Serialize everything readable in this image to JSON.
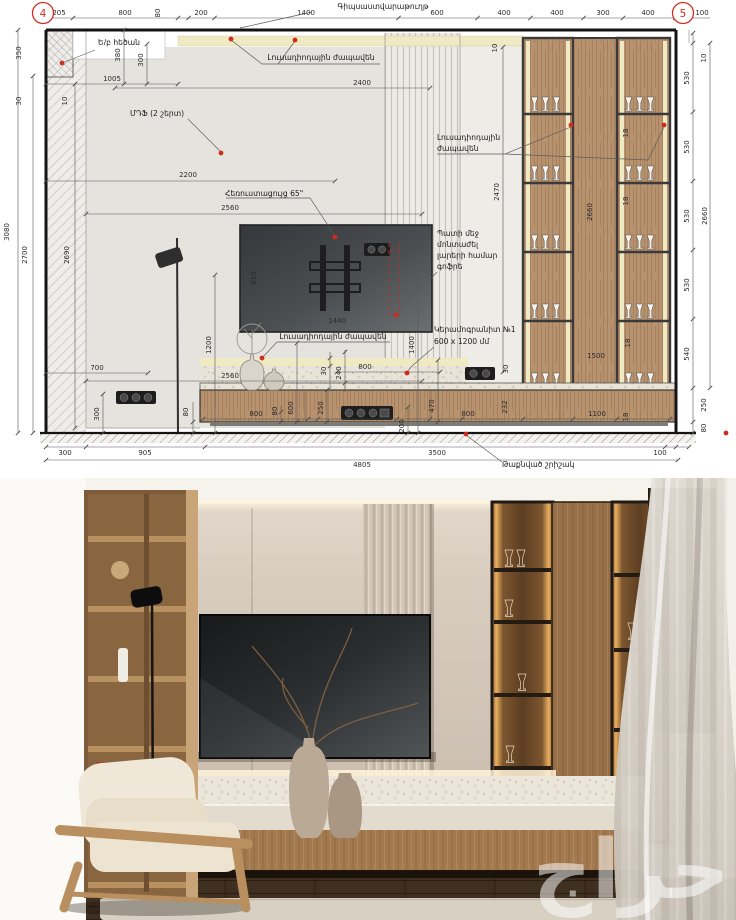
{
  "colors": {
    "marker-red": "#cf2b1f",
    "led-yellow": "#efe9c4",
    "wood": "#b7926f",
    "wall-gray": "#e4e3de"
  },
  "drawing": {
    "markers": {
      "left": "4",
      "right": "5"
    },
    "labels": {
      "gypsum": "Գիպսաստվարաթուղթ",
      "beam": "Ե/բ հեծան",
      "led1": "Լուսադիոդային ժապավեն",
      "mdf": "ՄԴՖ (2 շերտ)",
      "led2_l1": "Լուսադիոդային",
      "led2_l2": "ժապավեն",
      "tv": "Հեռուստացույց 65\"",
      "conduit_l1": "Պատի մեջ",
      "conduit_l2": "մոնտաժել",
      "conduit_l3": "լարերի համար",
      "conduit_l4": "գոֆրե",
      "led3": "Լուսադիոդային ժապավեն",
      "ceramic_l1": "Կերամոգրանիտ №1",
      "ceramic_l2": "600 x 1200 մմ",
      "plinth": "Թաքնված շրիշակ"
    },
    "dims": {
      "top": [
        "205",
        "800",
        "80",
        "200",
        "1400",
        "600",
        "400",
        "400",
        "300",
        "400",
        "100"
      ],
      "left": [
        "350",
        "30",
        "10",
        "3080",
        "2700",
        "2690"
      ],
      "beam": [
        "380",
        "300",
        "1005"
      ],
      "ceiling": [
        "2400",
        "10"
      ],
      "wall": [
        "2200",
        "2560",
        "810",
        "1440",
        "2470",
        "1400"
      ],
      "cabinet": [
        "2660",
        "1500",
        "18",
        "18",
        "18"
      ],
      "right": [
        "10",
        "530",
        "530",
        "530",
        "530",
        "540",
        "2660",
        "250",
        "80"
      ],
      "bench_upper": [
        "30",
        "240",
        "800",
        "2560",
        "30"
      ],
      "bench_left": [
        "700",
        "300",
        "80",
        "1200"
      ],
      "bench": [
        "800",
        "80",
        "600",
        "250",
        "200",
        "470",
        "800",
        "232",
        "1100",
        "18"
      ],
      "bottom": [
        "300",
        "905",
        "3500",
        "100",
        "4805"
      ]
    }
  },
  "photo": {
    "watermark": "حراج"
  }
}
